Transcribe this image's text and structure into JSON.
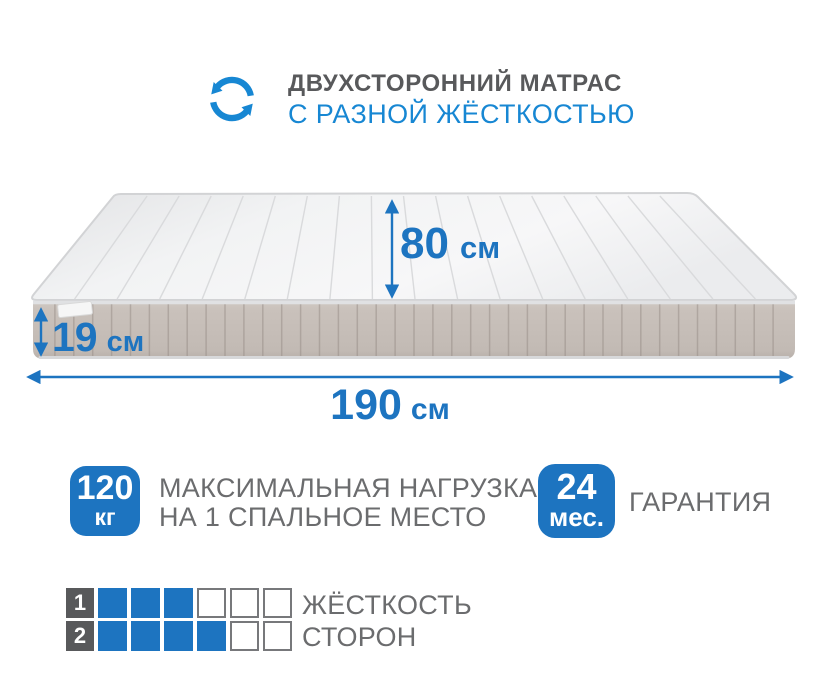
{
  "colors": {
    "accent": "#1d74c0",
    "header_accent": "#1787d3",
    "title_gray": "#58595b",
    "text_gray": "#6b6c6e",
    "square_border": "#77787b",
    "label_square_bg": "#58595b"
  },
  "header": {
    "title": "ДВУХСТОРОННИЙ МАТРАС",
    "subtitle": "С РАЗНОЙ ЖЁСТКОСТЬЮ"
  },
  "dimensions": {
    "depth": {
      "value": "80",
      "unit": "см"
    },
    "height": {
      "value": "19",
      "unit": "см"
    },
    "length": {
      "value": "190",
      "unit": "см"
    }
  },
  "features": [
    {
      "badge_value": "120",
      "badge_unit": "кг",
      "lines": [
        "МАКСИМАЛЬНАЯ НАГРУЗКА",
        "НА 1 СПАЛЬНОЕ МЕСТО"
      ]
    },
    {
      "badge_value": "24",
      "badge_unit": "мес.",
      "lines": [
        "ГАРАНТИЯ"
      ]
    }
  ],
  "firmness": {
    "rows": [
      {
        "index": "1",
        "filled": 3,
        "total": 6
      },
      {
        "index": "2",
        "filled": 4,
        "total": 6
      }
    ],
    "label_lines": [
      "ЖЁСТКОСТЬ",
      "СТОРОН"
    ]
  }
}
